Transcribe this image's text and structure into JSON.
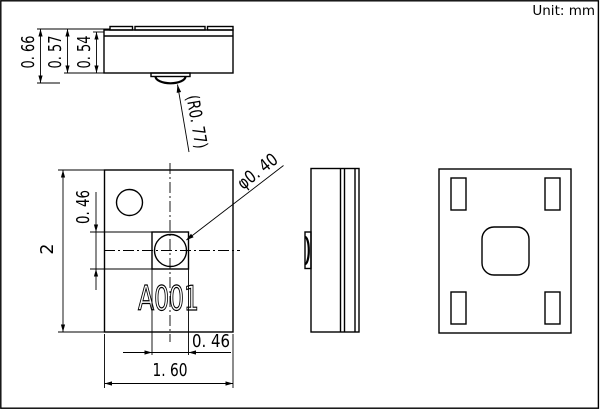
{
  "sheet": {
    "unit_note": "Unit: mm"
  },
  "side_view": {
    "dim_total_height": "0. 66",
    "dim_lid_height": "0. 57",
    "dim_body_height": "0. 54",
    "dim_dome_radius": "(R0. 77)"
  },
  "top_view": {
    "dim_height": "2",
    "dim_hole_offset_vertical": "0. 46",
    "dim_hole_offset_horizontal": "0. 46",
    "dim_width": "1. 60",
    "dim_hole_diameter": "φ0. 40",
    "marking": "A001"
  }
}
